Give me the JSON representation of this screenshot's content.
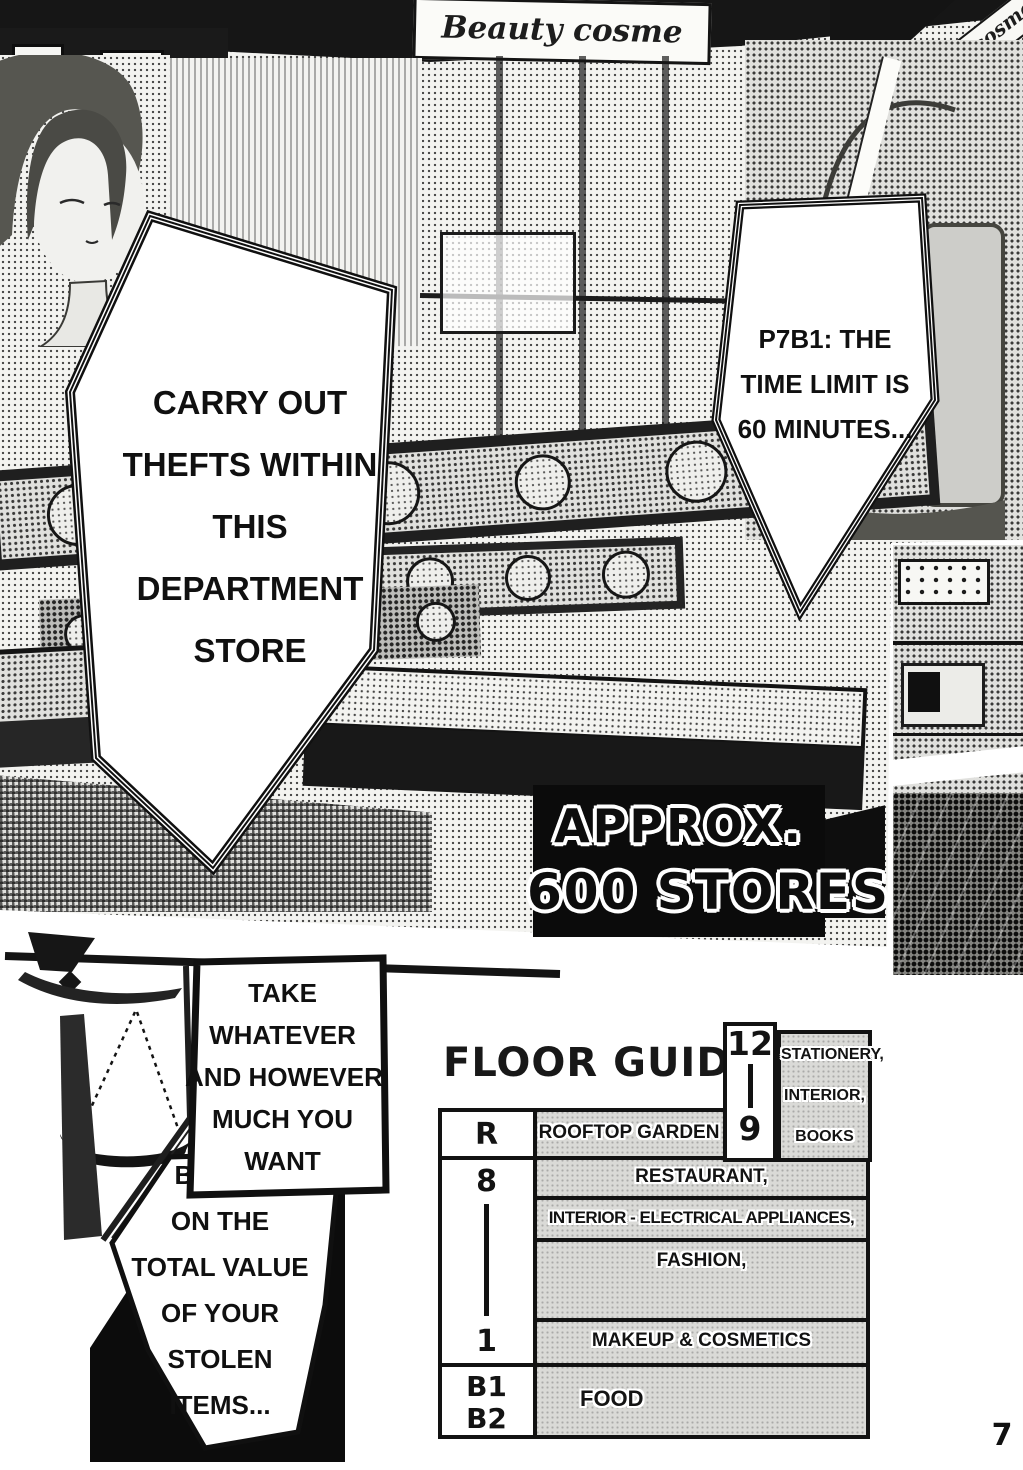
{
  "page_number": "7",
  "colors": {
    "ink": "#111111",
    "paper": "#ffffff",
    "cell_gray": "#dadad7"
  },
  "store_signs": {
    "top_banner": "Beauty cosme",
    "right_banner": "Beauty cosme"
  },
  "speech_bubbles": {
    "carry_out": {
      "lines": [
        "CARRY OUT",
        "THEFTS WITHIN",
        "THIS",
        "DEPARTMENT",
        "STORE"
      ]
    },
    "time_limit": {
      "lines": [
        "P7B1: THE",
        "TIME LIMIT IS",
        "60 MINUTES..."
      ]
    },
    "take_whatever": {
      "lines": [
        "TAKE",
        "WHATEVER",
        "AND HOWEVER",
        "MUCH YOU",
        "WANT"
      ]
    },
    "based_on": {
      "lines": [
        "BASED",
        "ON THE",
        "TOTAL VALUE",
        "OF YOUR",
        "STOLEN",
        "ITEMS..."
      ]
    }
  },
  "caption_box": {
    "lines": [
      "APPROX.",
      "600 STORES"
    ]
  },
  "floor_guide": {
    "title": "FLOOR GUIDE",
    "upper_right": {
      "floor_top": "12",
      "floor_bottom": "9",
      "labels": [
        "STATIONERY,",
        "INTERIOR,",
        "BOOKS"
      ]
    },
    "rows": {
      "rooftop": {
        "floor": "R",
        "label": "ROOFTOP GARDEN"
      },
      "mid": {
        "floor_top": "8",
        "floor_bottom": "1",
        "labels": [
          "RESTAURANT,",
          "INTERIOR - ELECTRICAL APPLIANCES,",
          "FASHION,",
          "MAKEUP & COSMETICS"
        ]
      },
      "basement": {
        "floor_top": "B1",
        "floor_bottom": "B2",
        "label": "FOOD"
      }
    }
  }
}
